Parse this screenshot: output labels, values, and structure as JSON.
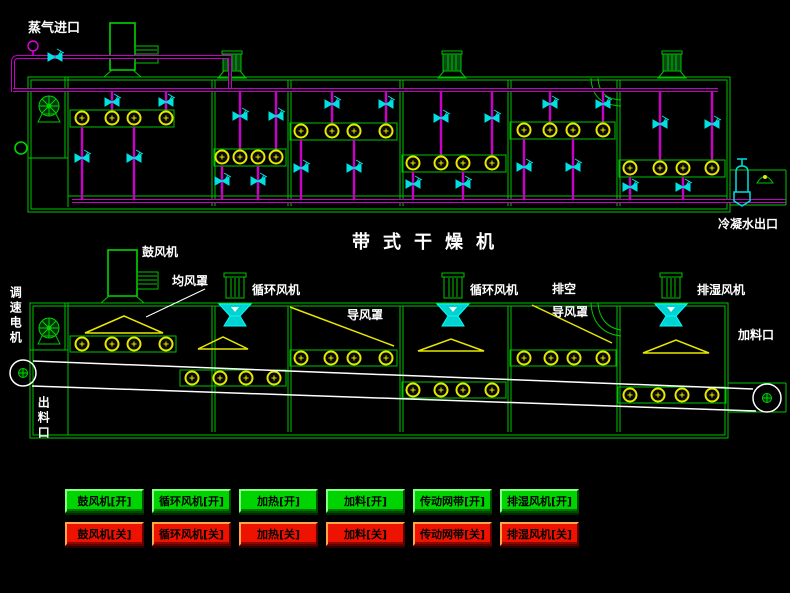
{
  "title": "带式干燥机",
  "top_diagram": {
    "steam_inlet": "蒸气进口",
    "condensate_outlet": "冷凝水出口"
  },
  "middle_diagram": {
    "speed_motor": "调速电机",
    "blower": "鼓风机",
    "air_equalize_hood": "均风罩",
    "circulating_fan_left": "循环风机",
    "guide_hood_left": "导风罩",
    "circulating_fan_right": "循环风机",
    "vent": "排空",
    "guide_hood_right": "导风罩",
    "dehumidify_fan": "排湿风机",
    "feed_inlet": "加料口",
    "discharge_outlet": "出料口"
  },
  "buttons": {
    "on": [
      {
        "label": "鼓风机[开]"
      },
      {
        "label": "循环风机[开]"
      },
      {
        "label": "加热[开]"
      },
      {
        "label": "加料[开]"
      },
      {
        "label": "传动网带[开]"
      },
      {
        "label": "排湿风机[开]"
      }
    ],
    "off": [
      {
        "label": "鼓风机[关]"
      },
      {
        "label": "循环风机[关]"
      },
      {
        "label": "加热[关]"
      },
      {
        "label": "加料[关]"
      },
      {
        "label": "传动网带[关]"
      },
      {
        "label": "排湿风机[关]"
      }
    ]
  },
  "colors": {
    "frame_green": "#00c400",
    "pipe_magenta": "#c800c8",
    "valve_cyan": "#00e0e0",
    "coil_yellow": "#e8e800",
    "belt_white": "#ffffff",
    "button_on": "#00d400",
    "button_off": "#ee1200"
  }
}
